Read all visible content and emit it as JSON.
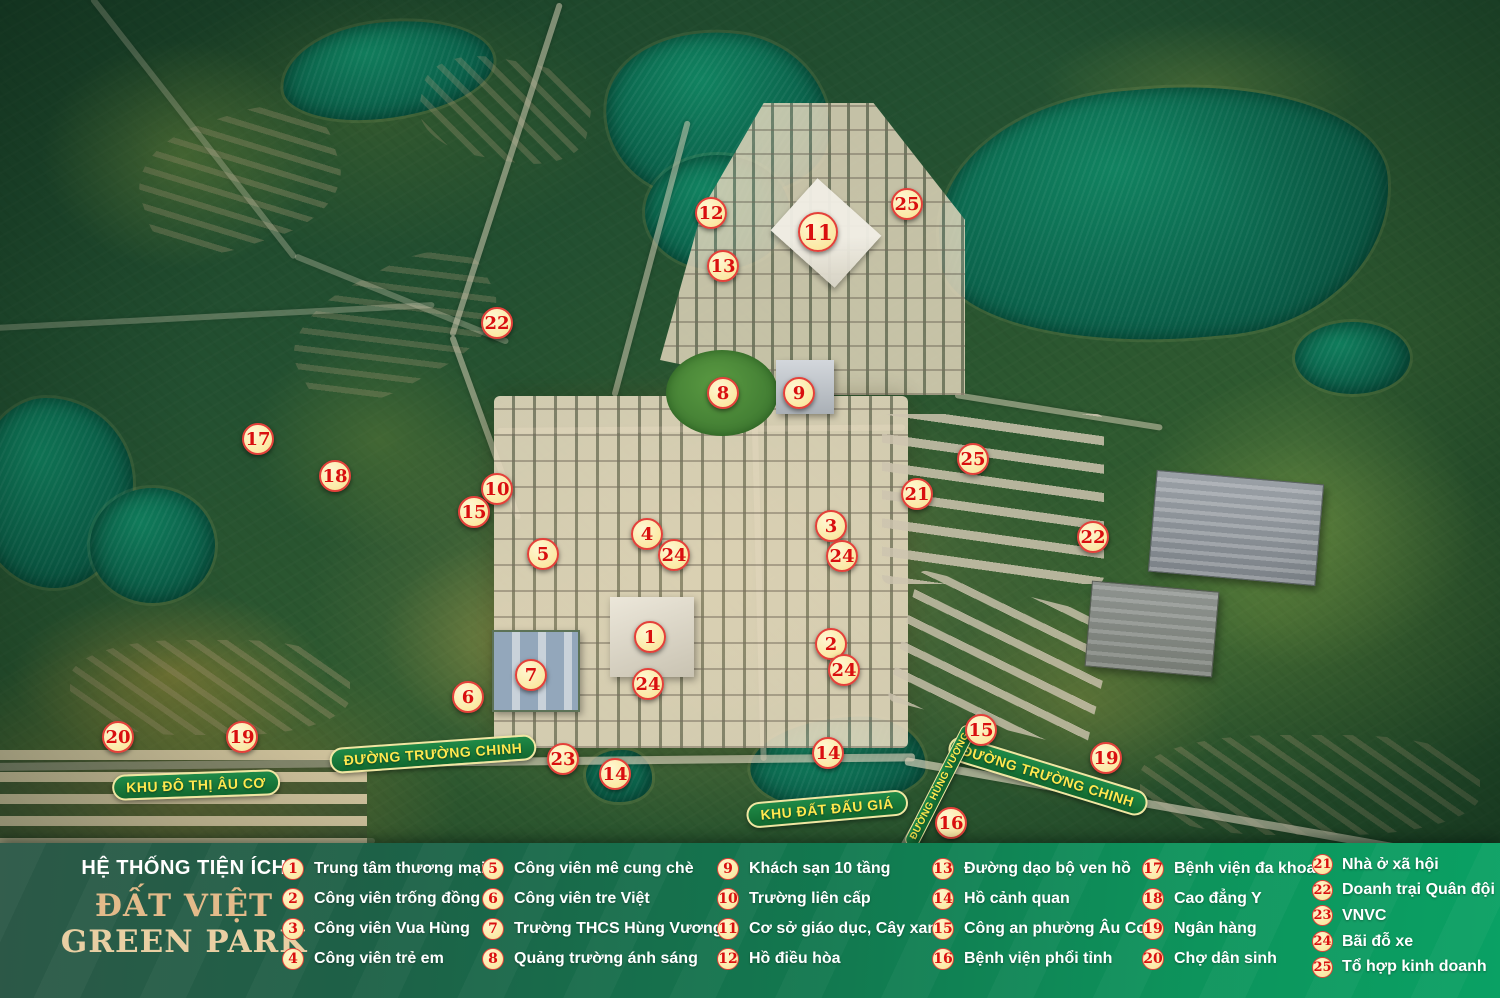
{
  "project": {
    "legend_title": "HỆ THỐNG TIỆN ÍCH",
    "name_line1": "ĐẤT VIỆT",
    "name_line2": "GREEN PARK"
  },
  "colors": {
    "legend_bg_left": "#2c5847",
    "legend_bg_right": "#0aa164",
    "marker_fill": "#fbe9a4",
    "marker_border": "#e4403a",
    "marker_number": "#d90f0f",
    "badge_bg": "#1f8a47",
    "badge_border": "#f0e7a2",
    "badge_text": "#ffe84f",
    "title_accent": "#e3ba8a",
    "lake": "#0a5c47",
    "terrain": "#27512d"
  },
  "legend": {
    "columns": [
      {
        "items": [
          {
            "num": "1",
            "label": "Trung tâm thương mại"
          },
          {
            "num": "2",
            "label": "Công viên trống đồng"
          },
          {
            "num": "3",
            "label": "Công viên Vua Hùng"
          },
          {
            "num": "4",
            "label": "Công viên trẻ em"
          }
        ]
      },
      {
        "items": [
          {
            "num": "5",
            "label": "Công viên mê cung chè"
          },
          {
            "num": "6",
            "label": "Công viên tre Việt"
          },
          {
            "num": "7",
            "label": "Trường THCS Hùng Vương"
          },
          {
            "num": "8",
            "label": "Quảng trường ánh sáng"
          }
        ]
      },
      {
        "items": [
          {
            "num": "9",
            "label": "Khách sạn 10 tầng"
          },
          {
            "num": "10",
            "label": "Trường liên cấp"
          },
          {
            "num": "11",
            "label": "Cơ sở giáo dục, Cây xanh"
          },
          {
            "num": "12",
            "label": "Hồ điều hòa"
          }
        ]
      },
      {
        "items": [
          {
            "num": "13",
            "label": "Đường dạo bộ ven hồ"
          },
          {
            "num": "14",
            "label": "Hồ cảnh quan"
          },
          {
            "num": "15",
            "label": "Công an phường Âu Cơ"
          },
          {
            "num": "16",
            "label": "Bệnh viện phổi tỉnh"
          }
        ]
      },
      {
        "items": [
          {
            "num": "17",
            "label": "Bệnh viện đa khoa"
          },
          {
            "num": "18",
            "label": "Cao đẳng Y"
          },
          {
            "num": "19",
            "label": "Ngân hàng"
          },
          {
            "num": "20",
            "label": "Chợ dân sinh"
          }
        ]
      },
      {
        "tight": true,
        "items": [
          {
            "num": "21",
            "label": "Nhà ở xã hội"
          },
          {
            "num": "22",
            "label": "Doanh trại Quân đội"
          },
          {
            "num": "23",
            "label": "VNVC"
          },
          {
            "num": "24",
            "label": "Bãi đỗ xe"
          },
          {
            "num": "25",
            "label": "Tổ hợp kinh doanh"
          }
        ]
      }
    ]
  },
  "map": {
    "labels": [
      {
        "text": "KHU ĐÔ THỊ ÂU CƠ",
        "x": 196,
        "y": 785,
        "rotate": -2
      },
      {
        "text": "ĐƯỜNG TRƯỜNG CHINH",
        "x": 433,
        "y": 754,
        "rotate": -4
      },
      {
        "text": "KHU ĐẤT ĐẤU GIÁ",
        "x": 827,
        "y": 809,
        "rotate": -5
      },
      {
        "text": "ĐƯỜNG TRƯỜNG CHINH",
        "x": 1048,
        "y": 776,
        "rotate": 17
      },
      {
        "text": "ĐƯỜNG HÙNG VƯƠNG",
        "x": 940,
        "y": 786,
        "rotate": -63,
        "small": true
      }
    ],
    "markers": [
      {
        "num": "12",
        "x": 711,
        "y": 213
      },
      {
        "num": "25",
        "x": 907,
        "y": 204
      },
      {
        "num": "11",
        "x": 818,
        "y": 232,
        "big": true
      },
      {
        "num": "13",
        "x": 723,
        "y": 266
      },
      {
        "num": "22",
        "x": 497,
        "y": 323
      },
      {
        "num": "8",
        "x": 723,
        "y": 393
      },
      {
        "num": "9",
        "x": 799,
        "y": 393
      },
      {
        "num": "17",
        "x": 258,
        "y": 439
      },
      {
        "num": "25",
        "x": 973,
        "y": 459
      },
      {
        "num": "18",
        "x": 335,
        "y": 476
      },
      {
        "num": "10",
        "x": 497,
        "y": 489
      },
      {
        "num": "21",
        "x": 917,
        "y": 494
      },
      {
        "num": "15",
        "x": 474,
        "y": 512
      },
      {
        "num": "3",
        "x": 831,
        "y": 526
      },
      {
        "num": "4",
        "x": 647,
        "y": 534
      },
      {
        "num": "22",
        "x": 1093,
        "y": 537
      },
      {
        "num": "5",
        "x": 543,
        "y": 554
      },
      {
        "num": "24",
        "x": 674,
        "y": 555
      },
      {
        "num": "24",
        "x": 842,
        "y": 556
      },
      {
        "num": "1",
        "x": 650,
        "y": 637
      },
      {
        "num": "2",
        "x": 831,
        "y": 644
      },
      {
        "num": "24",
        "x": 844,
        "y": 670
      },
      {
        "num": "7",
        "x": 531,
        "y": 675
      },
      {
        "num": "24",
        "x": 648,
        "y": 684
      },
      {
        "num": "6",
        "x": 468,
        "y": 697
      },
      {
        "num": "15",
        "x": 981,
        "y": 730
      },
      {
        "num": "20",
        "x": 118,
        "y": 737
      },
      {
        "num": "19",
        "x": 242,
        "y": 737
      },
      {
        "num": "14",
        "x": 828,
        "y": 753
      },
      {
        "num": "19",
        "x": 1106,
        "y": 758
      },
      {
        "num": "23",
        "x": 563,
        "y": 759
      },
      {
        "num": "14",
        "x": 615,
        "y": 774
      },
      {
        "num": "16",
        "x": 951,
        "y": 823
      }
    ]
  }
}
